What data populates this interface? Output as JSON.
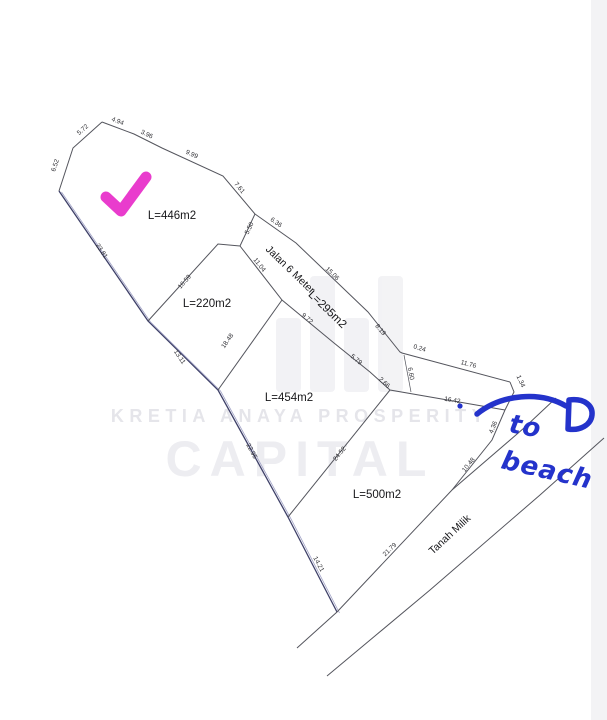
{
  "watermark": {
    "brand_line1": "KRETIA ANAYA PROSPERITY",
    "brand_line2": "CAPITAL",
    "color": "#e5e5ea"
  },
  "annotations": {
    "check_color": "#e93ccd",
    "pen_color": "#2433cb",
    "to_beach": {
      "line1": "to",
      "line2": "beach"
    }
  },
  "map": {
    "line_color": "#54555d",
    "boundary_color": "#3e4068",
    "plots": [
      {
        "id": "plot-446",
        "label": "L=446m2",
        "x": 172,
        "y": 219,
        "r": 0
      },
      {
        "id": "plot-220",
        "label": "L=220m2",
        "x": 207,
        "y": 307,
        "r": 0
      },
      {
        "id": "plot-454",
        "label": "L=454m2",
        "x": 289,
        "y": 401,
        "r": 0
      },
      {
        "id": "plot-500",
        "label": "L=500m2",
        "x": 377,
        "y": 498,
        "r": 0
      },
      {
        "id": "road-area-295",
        "label": "L=295m2",
        "x": 325,
        "y": 312,
        "r": 44
      }
    ],
    "roads": [
      {
        "id": "jalan-6-meter",
        "label": "Jalan 6 Meter",
        "x": 288,
        "y": 272,
        "r": 44
      },
      {
        "id": "tanah-milik",
        "label": "Tanah Milik",
        "x": 452,
        "y": 537,
        "r": -43
      }
    ],
    "dimensions": [
      {
        "v": "4.94",
        "x": 117,
        "y": 123,
        "r": 21
      },
      {
        "v": "3.96",
        "x": 146,
        "y": 136,
        "r": 26
      },
      {
        "v": "9.99",
        "x": 191,
        "y": 156,
        "r": 25
      },
      {
        "v": "7.61",
        "x": 238,
        "y": 189,
        "r": 50
      },
      {
        "v": "5.72",
        "x": 84,
        "y": 131,
        "r": -42
      },
      {
        "v": "6.52",
        "x": 57,
        "y": 166,
        "r": -72
      },
      {
        "v": "23.81",
        "x": 100,
        "y": 252,
        "r": 56
      },
      {
        "v": "13.11",
        "x": 178,
        "y": 358,
        "r": 56
      },
      {
        "v": "22.95",
        "x": 250,
        "y": 452,
        "r": 62
      },
      {
        "v": "14.21",
        "x": 317,
        "y": 565,
        "r": 62
      },
      {
        "v": "16.59",
        "x": 186,
        "y": 283,
        "r": -49
      },
      {
        "v": "5.50",
        "x": 251,
        "y": 229,
        "r": -64
      },
      {
        "v": "6.36",
        "x": 275,
        "y": 224,
        "r": 35
      },
      {
        "v": "15.06",
        "x": 331,
        "y": 275,
        "r": 44
      },
      {
        "v": "8.19",
        "x": 379,
        "y": 331,
        "r": 49
      },
      {
        "v": "0.24",
        "x": 419,
        "y": 350,
        "r": 17
      },
      {
        "v": "11.76",
        "x": 468,
        "y": 366,
        "r": 15
      },
      {
        "v": "1.34",
        "x": 519,
        "y": 382,
        "r": 66
      },
      {
        "v": "11.04",
        "x": 258,
        "y": 266,
        "r": 52
      },
      {
        "v": "9.72",
        "x": 306,
        "y": 320,
        "r": 40
      },
      {
        "v": "5.79",
        "x": 355,
        "y": 361,
        "r": 40
      },
      {
        "v": "2.66",
        "x": 383,
        "y": 384,
        "r": 43
      },
      {
        "v": "16.42",
        "x": 452,
        "y": 402,
        "r": 10
      },
      {
        "v": "6.60",
        "x": 409,
        "y": 374,
        "r": 80
      },
      {
        "v": "18.48",
        "x": 229,
        "y": 342,
        "r": -55
      },
      {
        "v": "24.52",
        "x": 341,
        "y": 455,
        "r": -51
      },
      {
        "v": "21.79",
        "x": 391,
        "y": 551,
        "r": -44
      },
      {
        "v": "4.36",
        "x": 495,
        "y": 428,
        "r": -68
      },
      {
        "v": "10.48",
        "x": 470,
        "y": 466,
        "r": -51
      }
    ]
  }
}
